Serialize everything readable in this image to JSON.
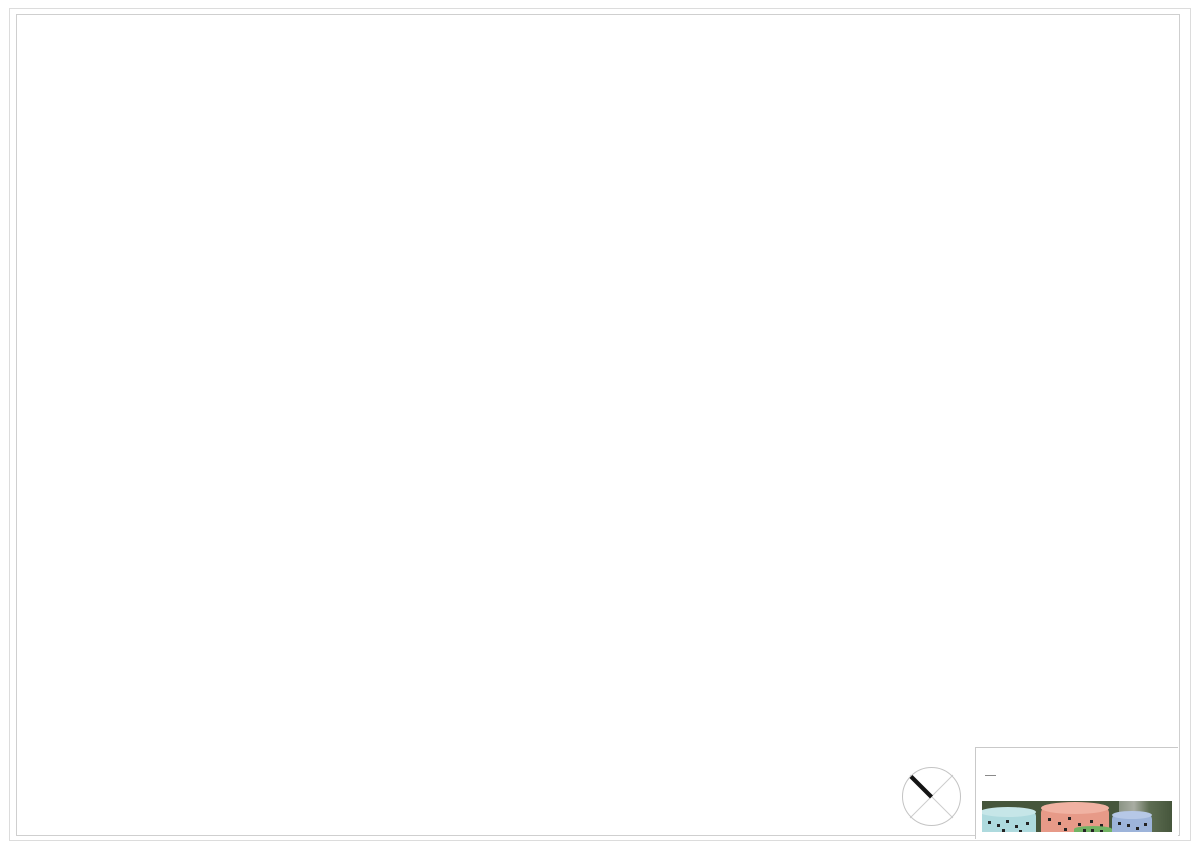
{
  "sheet": {
    "caption": "PLANTA PRIMERA. DISTRIBUCION.",
    "scale": "1:100"
  },
  "title_block": {
    "code": "GP_00115",
    "sheet_name": "PLANTA PRIMERA",
    "scale": "1:100",
    "firm": "FOURSQUARE ARCHITECTS",
    "architect": "ANA GARCIA SALA",
    "project_line1": "CENTRO DE EDUCACIÓN INFANTIL DE PRIMER Y SEGUNDO CICLO Y CENTRO DE INNOVACIÓN PARA LA INFANCIA",
    "project_line2": "PARQUE TECNOLOGICO DE PATERNA"
  },
  "plan_labels": {
    "acceso_vehicular": "ACCESO VEHICULAR",
    "acceso_principal_l1": "ACCESO",
    "acceso_principal_l2": "PRINCIPAL",
    "north": "N",
    "oficinas": "OFICINAS",
    "aseo": "ASEO",
    "terraza_l1": "TERRAZA",
    "terraza_l2": "DEL PROFESORADO",
    "aula_top": "AULA DE 2 A 3 AÑOS",
    "aula_right": "AULA DE 2 A 3 AÑOS",
    "aula_bottom": "AULA DE 1 A 2 AÑOS",
    "sala_usos_l1": "SALA USOS M.",
    "sala_usos_l2": "ALUMNOS DE",
    "sala_usos_l3": "0 A 1 AÑOS",
    "cocina": "COCINA",
    "comedor": "COMEDOR",
    "aula_comedor": "AULA DE 2 A 3 AÑOS"
  },
  "colors": {
    "tree_palette": [
      "#4a7c59",
      "#6fa06f",
      "#3c6b57",
      "#8fae6b",
      "#c9b44a",
      "#5b9387",
      "#d9c05a",
      "#a3c585"
    ],
    "speckle": "#c4c4c4",
    "line_strong": "#9a9a9a",
    "line_light": "#c8c8c8",
    "bird": "#1c1c1c",
    "accent_black": "#111111",
    "logo_squares": [
      "#d4c34a",
      "#6fa06f",
      "#3c6b57",
      "#b8b8b8"
    ],
    "photo": {
      "background": "#46563c",
      "cylinder_cyan": "#aedade",
      "cylinder_salmon": "#e79a88",
      "cylinder_blue": "#9db4da",
      "cylinder_green": "#72b364",
      "road": "#a9ada3"
    }
  }
}
